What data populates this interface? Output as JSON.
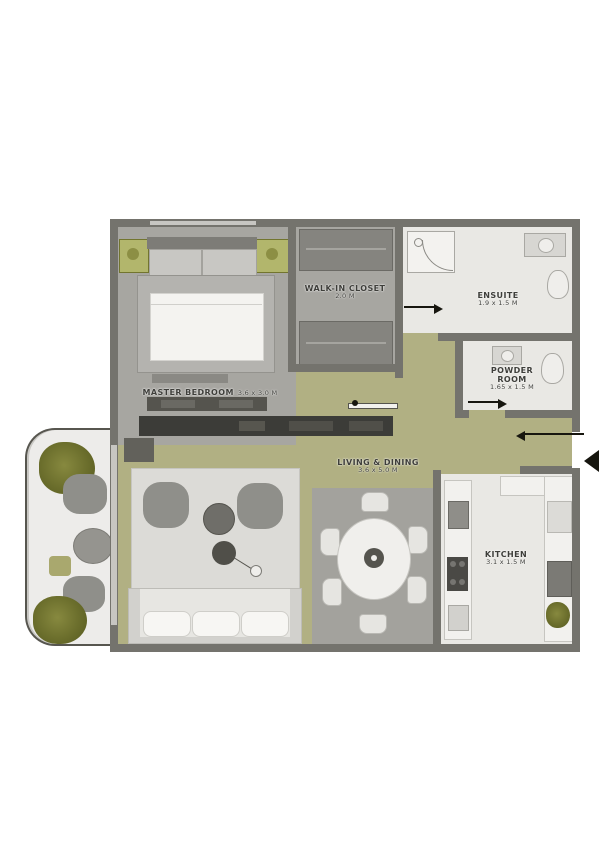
{
  "title": "apartment-floor-plan",
  "colors": {
    "wall": "#74736d",
    "floor_khaki": "#b1b083",
    "floor_gray": "#a7a6a1",
    "floor_white": "#e9e8e4",
    "balcony_floor": "#edecea",
    "plant_olive": "#6b6e2c",
    "accent_olive_block": "#b2b66c",
    "console_dark": "#3c3c38",
    "arrow_black": "#17160f",
    "label_text": "#3e3e3a"
  },
  "rooms": [
    {
      "id": "master-bedroom",
      "label": "MASTER BEDROOM",
      "dim": "3.6 x 3.0 M"
    },
    {
      "id": "walk-in-closet",
      "label": "WALK-IN CLOSET",
      "dim": "2.0 M"
    },
    {
      "id": "ensuite",
      "label": "ENSUITE",
      "dim": "1.9 x 1.5 M"
    },
    {
      "id": "powder-room",
      "label": "POWDER\nROOM",
      "dim": "1.65 x 1.5 M"
    },
    {
      "id": "living-dining",
      "label": "LIVING & DINING",
      "dim": "3.6 x 5.0 M"
    },
    {
      "id": "kitchen",
      "label": "KITCHEN",
      "dim": "3.1 x 1.5 M"
    }
  ],
  "icons": {
    "entry_arrow": "entry direction",
    "door_arrows": "door swing direction"
  }
}
